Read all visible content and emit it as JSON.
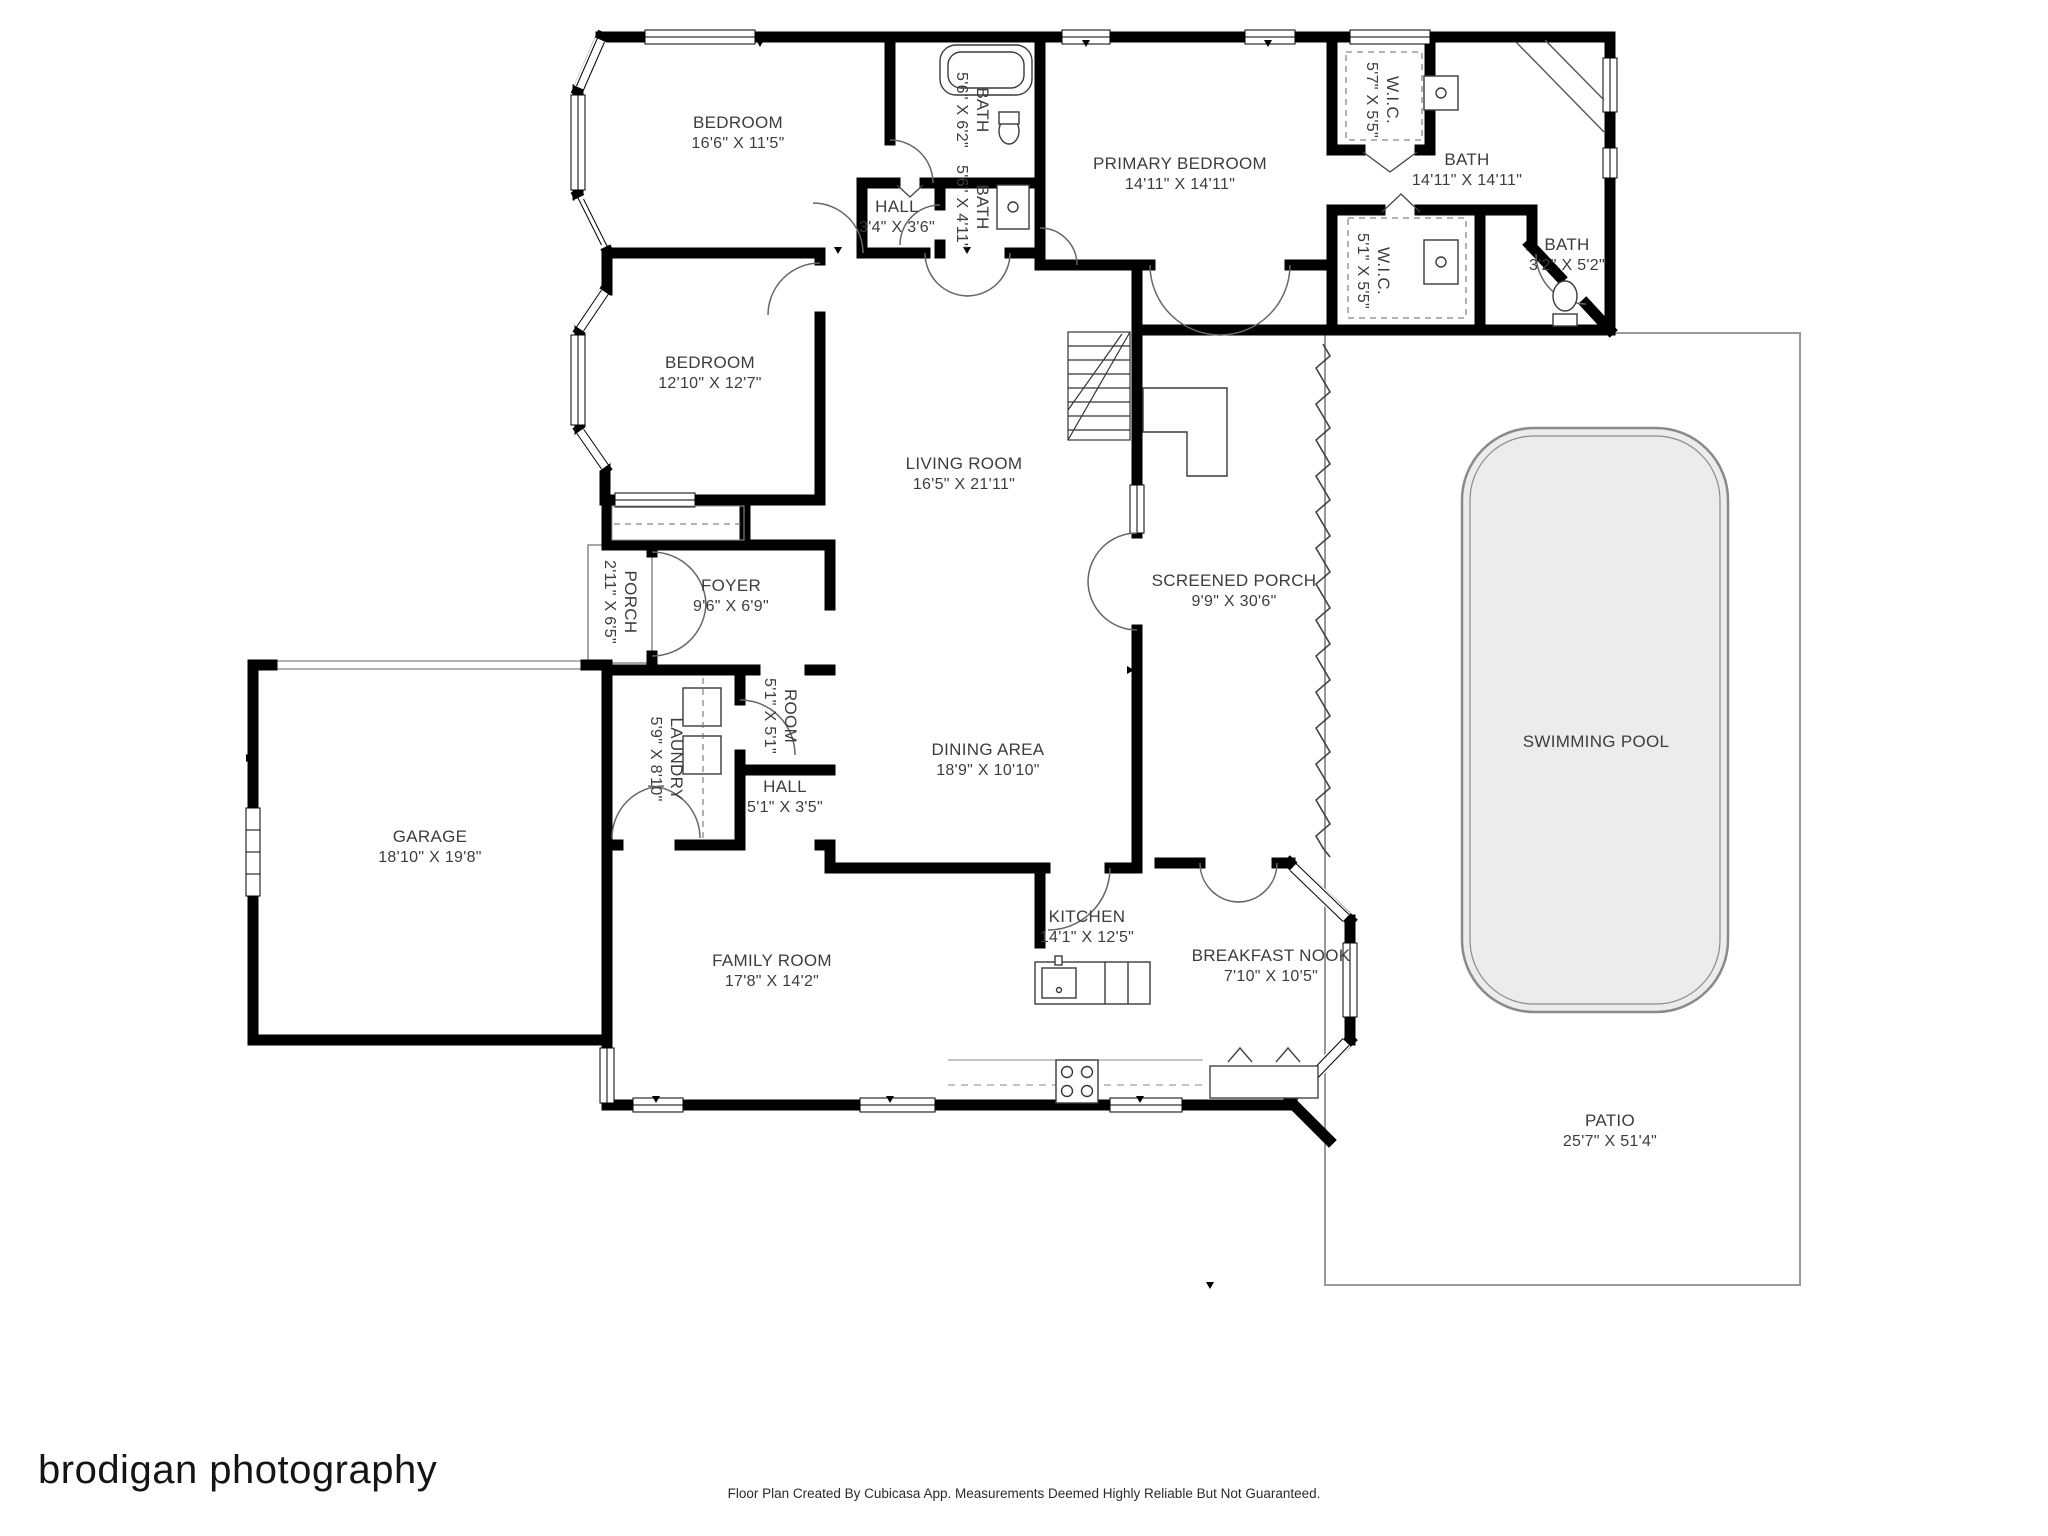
{
  "meta": {
    "brand": "brodigan photography",
    "credit_line": "Floor Plan Created By Cubicasa App. Measurements Deemed Highly Reliable But Not Guaranteed."
  },
  "colors": {
    "wall": "#000000",
    "pool_fill": "#ececec",
    "pool_outline": "#8a8a8a",
    "patio_outline": "#999999",
    "label_text": "#3d3d3d"
  },
  "rooms": [
    {
      "name": "BEDROOM",
      "dims": "16'6\" X 11'5\""
    },
    {
      "name": "BATH",
      "dims": "5'6\" X 6'2\""
    },
    {
      "name": "HALL",
      "dims": "3'4\" X 3'6\""
    },
    {
      "name": "BATH",
      "dims": "5'6\" X 4'11\""
    },
    {
      "name": "PRIMARY BEDROOM",
      "dims": "14'11\" X 14'11\""
    },
    {
      "name": "W.I.C.",
      "dims": "5'7\" X 5'5\""
    },
    {
      "name": "BATH",
      "dims": "14'11\" X 14'11\""
    },
    {
      "name": "W.I.C.",
      "dims": "5'1\" X 5'5\""
    },
    {
      "name": "BATH",
      "dims": "3'2\" X 5'2\""
    },
    {
      "name": "BEDROOM",
      "dims": "12'10\" X 12'7\""
    },
    {
      "name": "LIVING ROOM",
      "dims": "16'5\" X 21'11\""
    },
    {
      "name": "SCREENED PORCH",
      "dims": "9'9\" X 30'6\""
    },
    {
      "name": "PORCH",
      "dims": "2'11\" X 6'5\""
    },
    {
      "name": "FOYER",
      "dims": "9'6\" X 6'9\""
    },
    {
      "name": "LAUNDRY",
      "dims": "5'9\" X 8'10\""
    },
    {
      "name": "ROOM",
      "dims": "5'1\" X 5'1\""
    },
    {
      "name": "HALL",
      "dims": "5'1\" X 3'5\""
    },
    {
      "name": "GARAGE",
      "dims": "18'10\" X 19'8\""
    },
    {
      "name": "DINING AREA",
      "dims": "18'9\" X 10'10\""
    },
    {
      "name": "FAMILY ROOM",
      "dims": "17'8\" X 14'2\""
    },
    {
      "name": "KITCHEN",
      "dims": "14'1\" X 12'5\""
    },
    {
      "name": "BREAKFAST NOOK",
      "dims": "7'10\" X 10'5\""
    },
    {
      "name": "SWIMMING POOL",
      "dims": ""
    },
    {
      "name": "PATIO",
      "dims": "25'7\" X 51'4\""
    }
  ]
}
